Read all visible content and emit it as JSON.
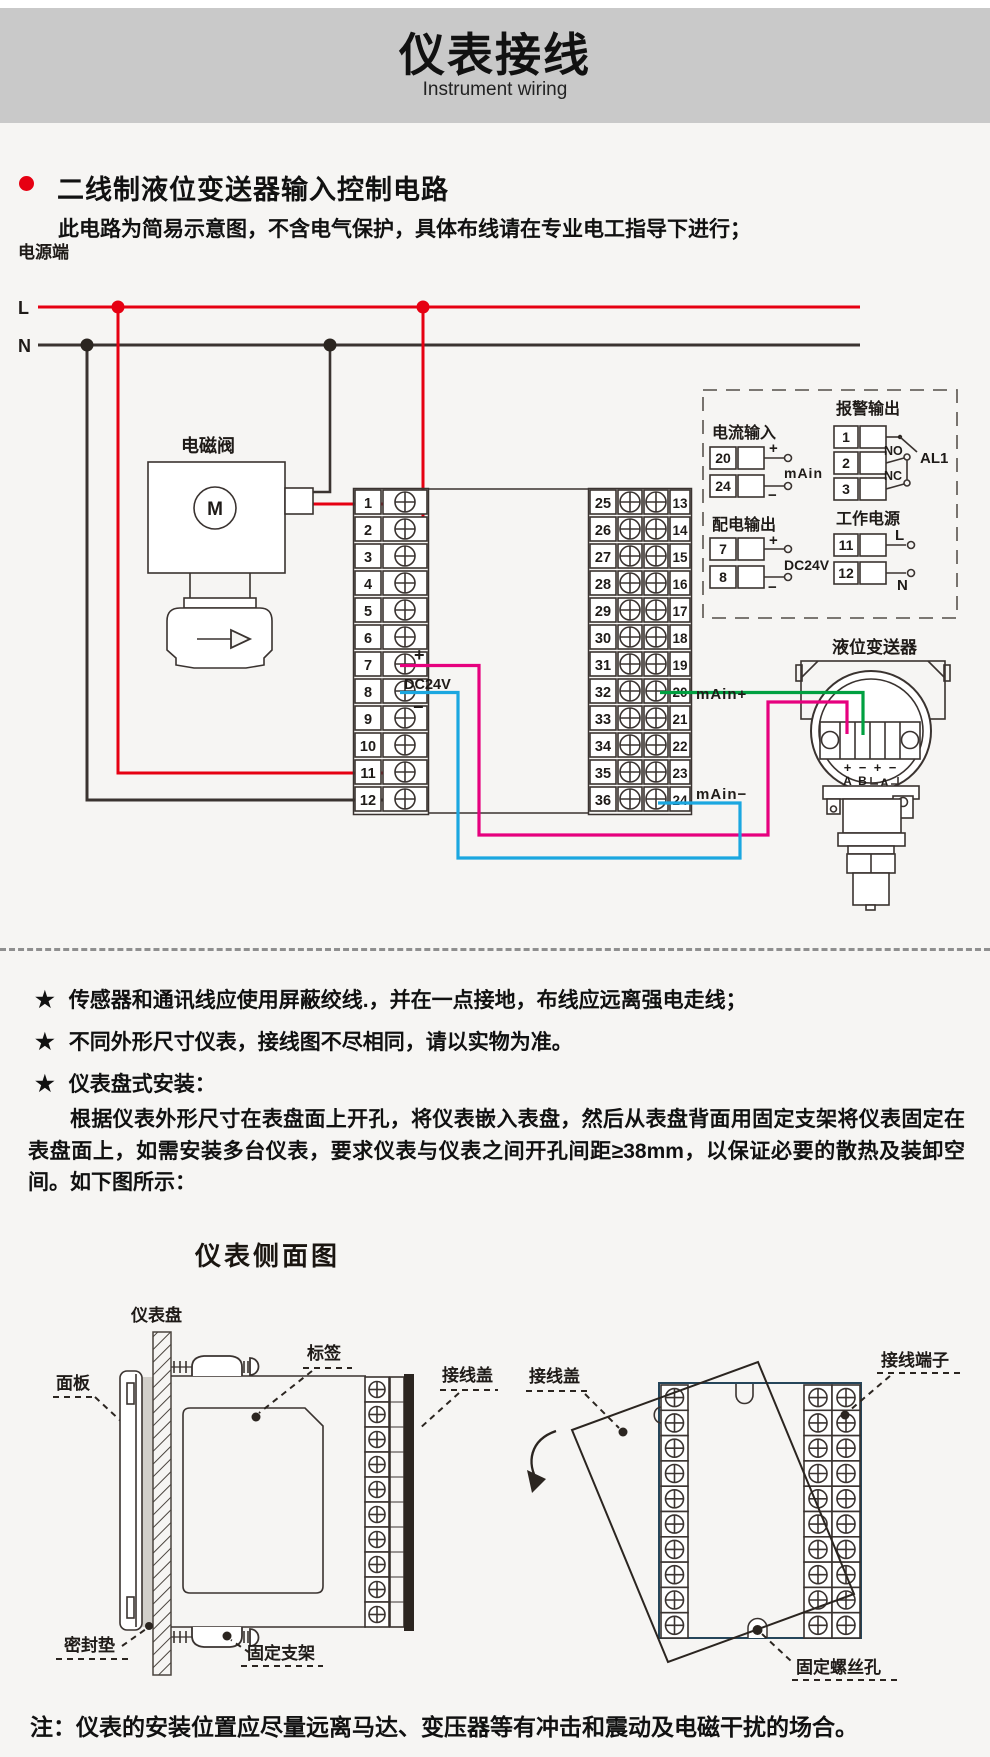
{
  "header": {
    "title": "仪表接线",
    "subtitle": "Instrument wiring",
    "banner_bg": "#c9c9c9"
  },
  "section": {
    "bullet_color": "#e60012",
    "title": "二线制液位变送器输入控制电路",
    "note": "此电路为简易示意图，不含电气保护，具体布线请在专业电工指导下进行；"
  },
  "wiring": {
    "power_label": "电源端",
    "line_l": "L",
    "line_n": "N",
    "solenoid_label": "电磁阀",
    "motor_letter": "M",
    "left_terminals": [
      "1",
      "2",
      "3",
      "4",
      "5",
      "6",
      "7",
      "8",
      "9",
      "10",
      "11",
      "12"
    ],
    "mid_left_terminals": [
      "25",
      "26",
      "27",
      "28",
      "29",
      "30",
      "31",
      "32",
      "33",
      "34",
      "35",
      "36"
    ],
    "mid_right_terminals": [
      "13",
      "14",
      "15",
      "16",
      "17",
      "18",
      "19",
      "20",
      "21",
      "22",
      "23",
      "24"
    ],
    "dc24v": {
      "plus": "+",
      "label": "DC24V",
      "minus": "−"
    },
    "main_plus": "mAin+",
    "main_minus": "mAin−",
    "panel": {
      "current_input": {
        "title": "电流输入",
        "terminals": [
          "20",
          "24"
        ],
        "plus": "+",
        "minus": "−",
        "label": "mAin"
      },
      "alarm_output": {
        "title": "报警输出",
        "terminals": [
          "1",
          "2",
          "3"
        ],
        "no": "NO",
        "nc": "NC",
        "al1": "AL1"
      },
      "dist_output": {
        "title": "配电输出",
        "terminals": [
          "7",
          "8"
        ],
        "plus": "+",
        "minus": "−",
        "label": "DC24V"
      },
      "work_power": {
        "title": "工作电源",
        "terminals": [
          "11",
          "12"
        ],
        "l": "L",
        "n": "N"
      }
    },
    "transmitter": {
      "title": "液位变送器",
      "signs": [
        "+",
        "−",
        "+",
        "−"
      ],
      "letters": [
        "A",
        "B",
        "A"
      ]
    },
    "colors": {
      "red": "#e60012",
      "black": "#3a3330",
      "magenta": "#e6007e",
      "blue": "#1ba7e0",
      "green": "#00a040"
    }
  },
  "notes": {
    "star": "★",
    "items": [
      {
        "text": "传感器和通讯线应使用屏蔽绞线.，并在一点接地，布线应远离强电走线；"
      },
      {
        "text": "不同外形尺寸仪表，接线图不尽相同，请以实物为准。"
      },
      {
        "text": "仪表盘式安装："
      }
    ]
  },
  "install": {
    "paragraph": "根据仪表外形尺寸在表盘面上开孔，将仪表嵌入表盘，然后从表盘背面用固定支架将仪表固定在表盘面上，如需安装多台仪表，要求仪表与仪表之间开孔间距≥38mm，以保证必要的散热及装卸空间。如下图所示：",
    "side_title": "仪表侧面图",
    "labels": {
      "panel_board": "仪表盘",
      "front_panel": "面板",
      "tag": "标签",
      "cover_left": "接线盖",
      "gasket": "密封垫",
      "bracket": "固定支架",
      "cover_right": "接线盖",
      "terminal_block": "接线端子",
      "screw_hole": "固定螺丝孔"
    }
  },
  "footer": {
    "note": "注：仪表的安装位置应尽量远离马达、变压器等有冲击和震动及电磁干扰的场合。"
  }
}
